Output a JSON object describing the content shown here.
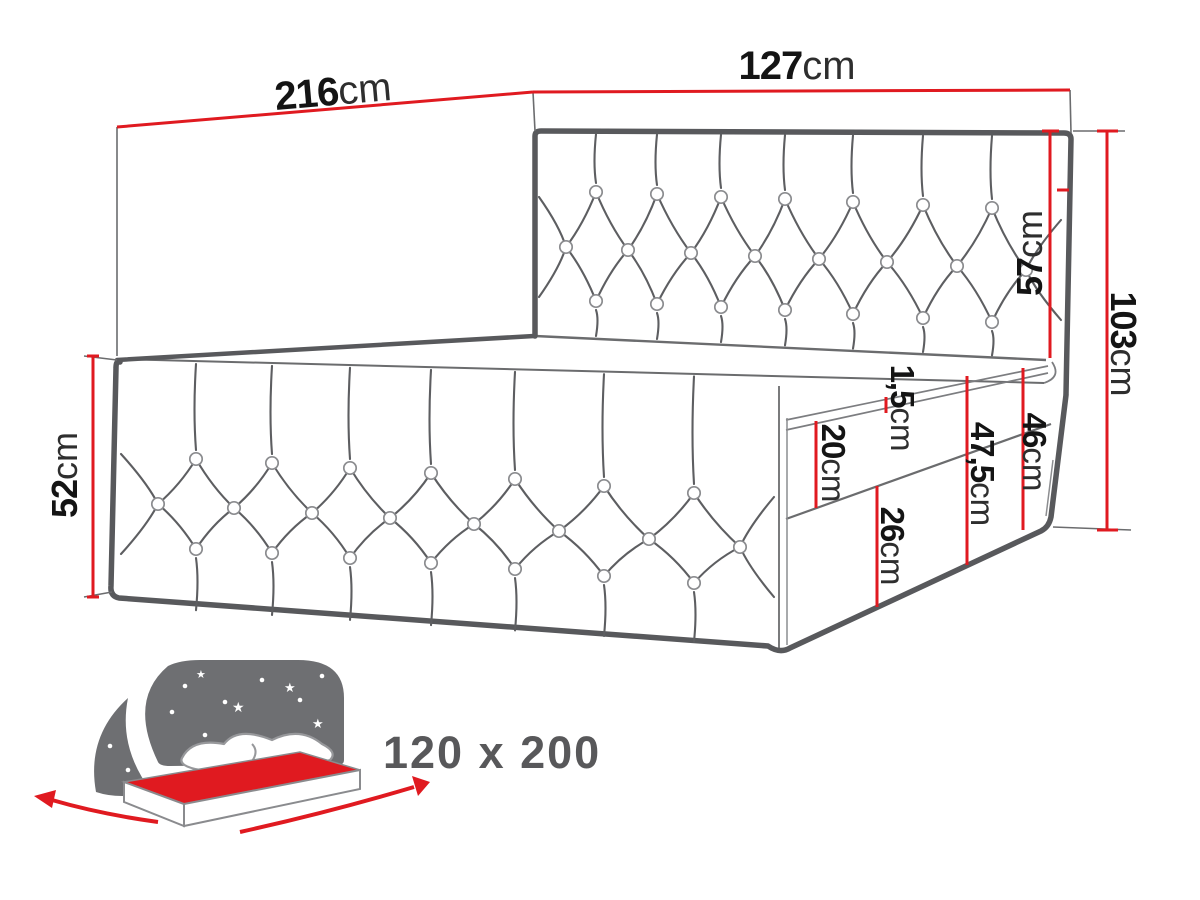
{
  "diagram": {
    "type": "bed-dimension-diagram",
    "colors": {
      "accent": "#e01a20",
      "line": "#5b5c5e",
      "label": "#141414",
      "badge_text": "#58585a",
      "icon_gray": "#6e6f72"
    },
    "dimensions": {
      "d216": {
        "value": "216",
        "unit": "cm"
      },
      "d127": {
        "value": "127",
        "unit": "cm"
      },
      "d57": {
        "value": "57",
        "unit": "cm"
      },
      "d103": {
        "value": "103",
        "unit": "cm"
      },
      "d52": {
        "value": "52",
        "unit": "cm"
      },
      "d1_5": {
        "value": "1,5",
        "unit": "cm"
      },
      "d20": {
        "value": "20",
        "unit": "cm"
      },
      "d47_5": {
        "value": "47,5",
        "unit": "cm"
      },
      "d46": {
        "value": "46",
        "unit": "cm"
      },
      "d26": {
        "value": "26",
        "unit": "cm"
      }
    },
    "badge": {
      "size_label": "120 x 200"
    }
  }
}
